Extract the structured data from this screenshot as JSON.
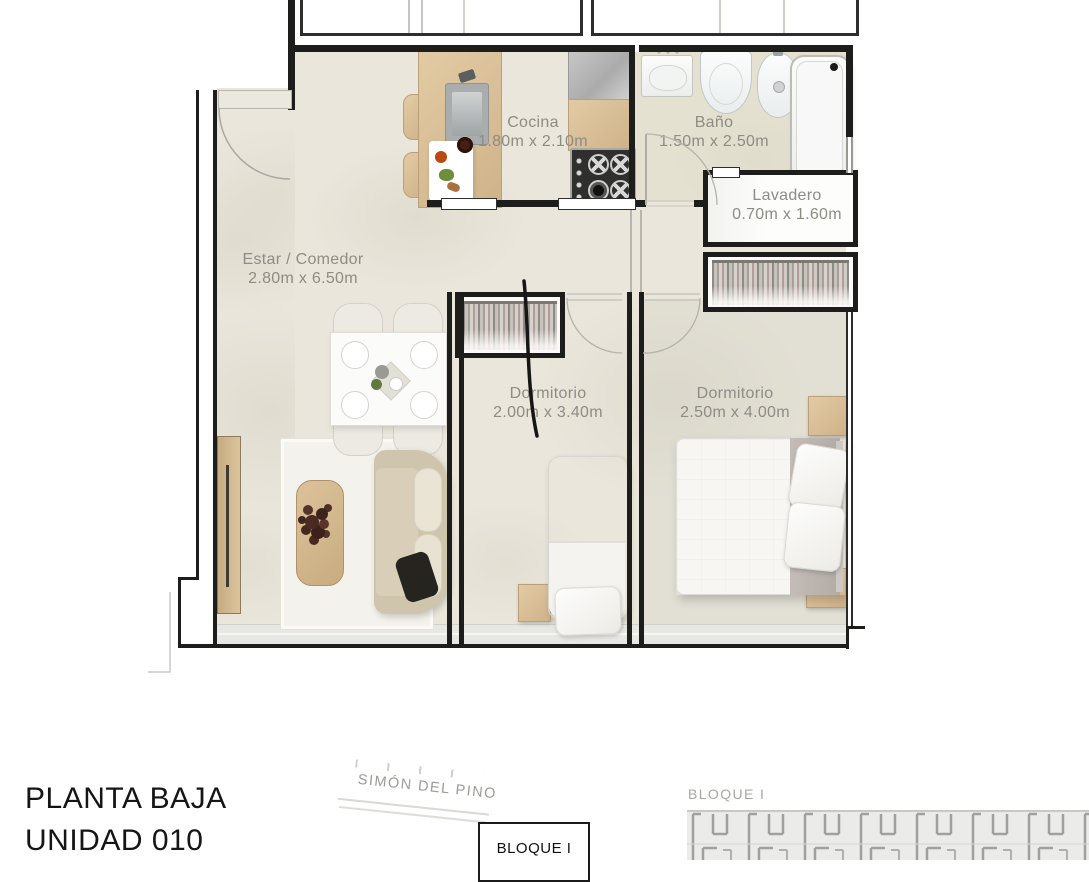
{
  "plan_title": {
    "line1": "PLANTA BAJA",
    "line2": "UNIDAD 010"
  },
  "rooms": [
    {
      "name": "Cocina",
      "dimensions": "1.80m x 2.10m"
    },
    {
      "name": "Baño",
      "dimensions": "1.50m x 2.50m"
    },
    {
      "name": "Lavadero",
      "dimensions": "0.70m x 1.60m"
    },
    {
      "name": "Estar / Comedor",
      "dimensions": "2.80m x 6.50m"
    },
    {
      "name": "Dormitorio",
      "dimensions": "2.00m x 3.40m"
    },
    {
      "name": "Dormitorio",
      "dimensions": "2.50m x 4.00m"
    }
  ],
  "street_label": "SIMÓN DEL PINO",
  "bloque_button": {
    "label": "BLOQUE I"
  },
  "site_plan": {
    "label": "BLOQUE I"
  },
  "colors": {
    "wall": "#1d1d1b",
    "floor": "#eae6db",
    "wood": "#d9c09a",
    "label_text": "#8d8c85",
    "title_text": "#151515",
    "site_plan_walls": "#a0a09c"
  }
}
